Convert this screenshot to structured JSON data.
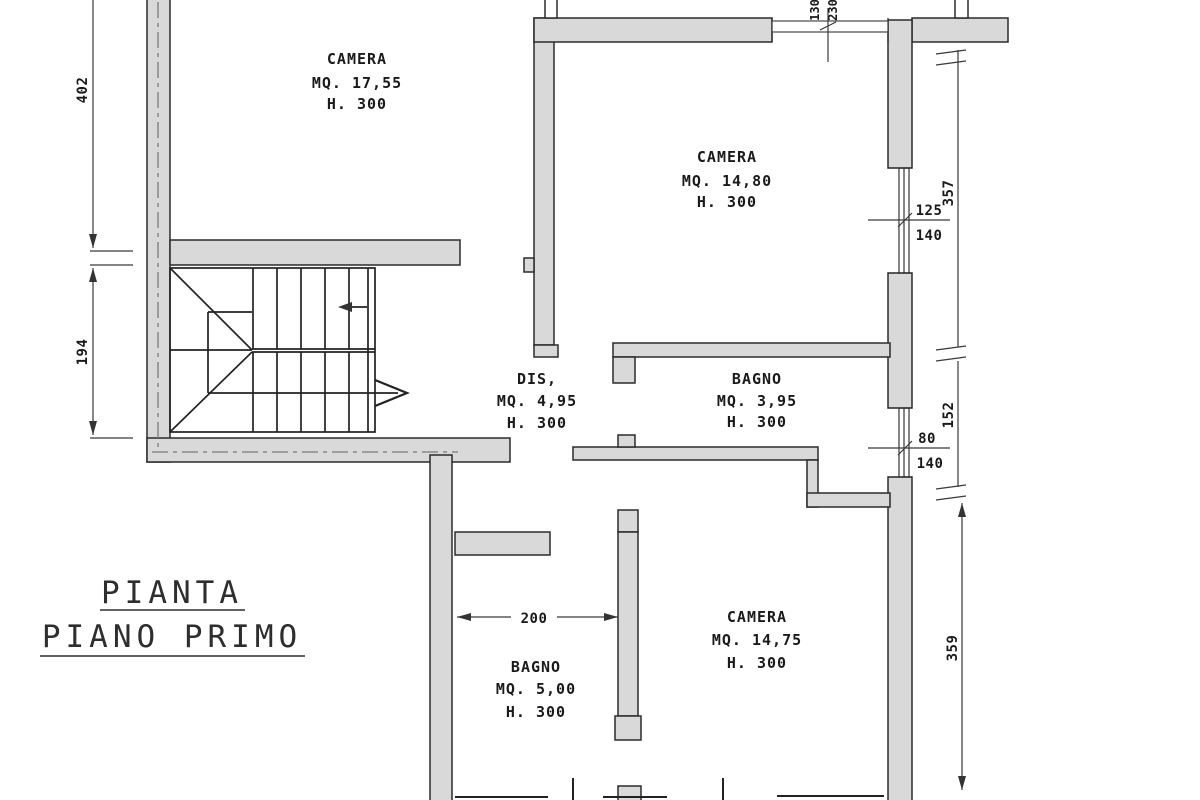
{
  "title": {
    "line1": "PIANTA",
    "line2": "PIANO PRIMO"
  },
  "rooms": [
    {
      "name": "CAMERA",
      "area": "MQ. 17,55",
      "height": "H. 300"
    },
    {
      "name": "CAMERA",
      "area": "MQ. 14,80",
      "height": "H. 300"
    },
    {
      "name": "DIS,",
      "area": "MQ. 4,95",
      "height": "H. 300"
    },
    {
      "name": "BAGNO",
      "area": "MQ. 3,95",
      "height": "H. 300"
    },
    {
      "name": "CAMERA",
      "area": "MQ. 14,75",
      "height": "H. 300"
    },
    {
      "name": "BAGNO",
      "area": "MQ. 5,00",
      "height": "H. 300"
    }
  ],
  "dimensions": {
    "left_top": "402",
    "left_mid": "194",
    "right_top": "357",
    "right_mid": "152",
    "right_bottom": "359",
    "bagno5_width": "200",
    "window_top_a": "130",
    "window_top_b": "230",
    "window1_a": "125",
    "window1_b": "140",
    "window2_a": "80",
    "window2_b": "140"
  },
  "colors": {
    "wall_fill": "#d9d9d9",
    "line": "#222222",
    "dimension": "#3a3a3a",
    "background": "#ffffff"
  }
}
